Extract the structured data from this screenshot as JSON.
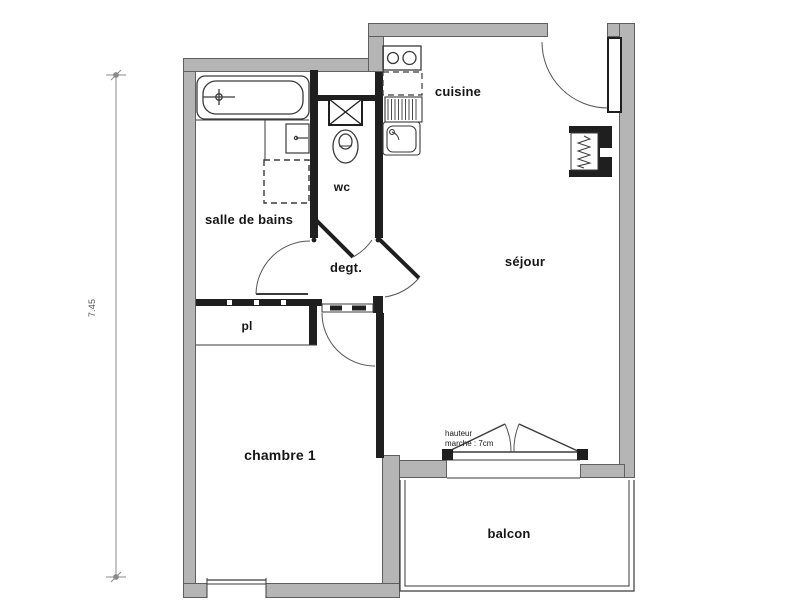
{
  "floor_plan": {
    "dimension_left": "7.45",
    "rooms": {
      "salle_de_bains": "salle de bains",
      "wc": "wc",
      "cuisine": "cuisine",
      "sejour": "séjour",
      "degagement": "degt.",
      "placard": "pl",
      "chambre": "chambre 1",
      "balcon": "balcon"
    },
    "annotations": {
      "step_note_line1": "hauteur",
      "step_note_line2": "marche : 7cm"
    },
    "colors": {
      "outer_wall": "#b5b5b5",
      "outer_wall_border": "#5f5f5f",
      "interior_wall": "#1f1f1f",
      "thin_line": "#3a3a3a",
      "dimension_line": "#8a8a8a",
      "background": "#ffffff"
    }
  }
}
